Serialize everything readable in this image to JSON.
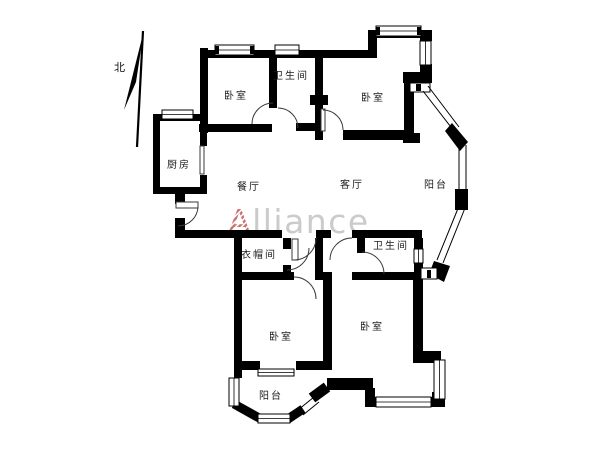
{
  "plan": {
    "type": "apartment-floor-plan",
    "north": {
      "label": "北"
    },
    "watermark": {
      "first_letter": "A",
      "rest": "lliance"
    },
    "rooms": {
      "bedroom_top_left": "卧室",
      "bathroom_top": "卫生间",
      "bedroom_top_right": "卧室",
      "kitchen": "厨房",
      "dining_room": "餐厅",
      "living_room": "客厅",
      "balcony_right": "阳台",
      "cloakroom": "衣帽间",
      "bathroom_middle": "卫生间",
      "bedroom_bottom_left": "卧室",
      "bedroom_bottom_right": "卧室",
      "balcony_bottom": "阳台"
    },
    "colors": {
      "background": "#ffffff",
      "wall": "#000000",
      "label_text": "#1d1d1d",
      "door_arc": "#3a3a3a",
      "watermark_a_stripe": "#c05858",
      "watermark_text": "#c2c2c2"
    }
  }
}
